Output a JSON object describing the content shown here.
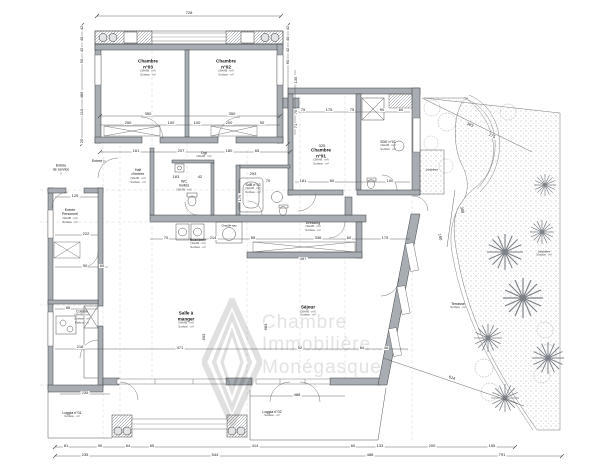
{
  "watermark": {
    "lines": [
      "Chambre",
      "Immobilière",
      "Monégasque"
    ],
    "color": "#e3e3e3"
  },
  "colors": {
    "wall": "#a7adb2",
    "wall_edge": "#3d4144",
    "line": "#555555",
    "dashed": "#8b9196",
    "stipple": "#8a8f94",
    "watermark": "#e3e3e3"
  },
  "plan": {
    "rooms": [
      {
        "name": "Chambre",
        "line2": "n°03",
        "subs": [
          "(SHAB · m²)",
          "Surface · m²"
        ],
        "x": 148,
        "y": 68,
        "cls": ""
      },
      {
        "name": "Chambre",
        "line2": "n°02",
        "subs": [
          "(SHAB · m²)",
          "Surface · m²"
        ],
        "x": 226,
        "y": 68,
        "cls": ""
      },
      {
        "name": "Chambre",
        "line2": "n°01",
        "subs": [
          "(SHAB · m²)",
          "Surface · m²"
        ],
        "x": 321,
        "y": 157,
        "cls": ""
      },
      {
        "name": "SDE n°01",
        "subs": [
          "(SHAB · m²)",
          "Surface · m²"
        ],
        "x": 388,
        "y": 146,
        "cls": "minor"
      },
      {
        "name": "SdB n°02",
        "subs": [
          "(SHAB · m²)",
          "Surface · m²"
        ],
        "x": 253,
        "y": 189,
        "cls": "minor"
      },
      {
        "name": "WC",
        "line2": "Invités",
        "subs": [
          "(SHAB · m²)"
        ],
        "x": 184,
        "y": 186,
        "cls": "minor"
      },
      {
        "name": "Dgt",
        "subs": [
          "(SHAB · m²)"
        ],
        "x": 204,
        "y": 155,
        "cls": "minor"
      },
      {
        "name": "Hall",
        "line2": "d'entrée",
        "subs": [
          "(SHAB · m²)",
          "Surface · m²"
        ],
        "x": 138,
        "y": 176,
        "cls": "minor"
      },
      {
        "name": "Entrée",
        "line2": "de service",
        "subs": [
          "▽"
        ],
        "x": 61,
        "y": 170,
        "cls": "minor"
      },
      {
        "name": "Entrée ▷",
        "subs": [],
        "x": 99,
        "y": 161,
        "cls": "minor"
      },
      {
        "name": "Entrée",
        "line2": "Personnel",
        "subs": [
          "(SHAB · m²)",
          "Surface · m²"
        ],
        "x": 70,
        "y": 216,
        "cls": "minor"
      },
      {
        "name": "Cuisine",
        "subs": [
          "(SHAB · m²)",
          "Surface · m²",
          "Plafond · m"
        ],
        "x": 82,
        "y": 317,
        "cls": "minor"
      },
      {
        "name": "Buanderie",
        "subs": [
          "(SHAB · m²)",
          "Surface · m²"
        ],
        "x": 198,
        "y": 244,
        "cls": "minor"
      },
      {
        "name": "Dressing",
        "subs": [
          "(SHAB · m²)",
          "Surface · m²"
        ],
        "x": 313,
        "y": 227,
        "cls": "minor"
      },
      {
        "name": "Chauffe-eau",
        "subs": [],
        "x": 229,
        "y": 226,
        "cls": "small"
      },
      {
        "name": "Salle à",
        "line2": "manger",
        "subs": [
          "(SHAB · m²)",
          "Surface · m²"
        ],
        "x": 186,
        "y": 320,
        "cls": ""
      },
      {
        "name": "Séjour",
        "subs": [
          "(SHAB · m²)",
          "Surface · m²"
        ],
        "x": 308,
        "y": 311,
        "cls": ""
      },
      {
        "name": "Loggia n°01",
        "subs": [
          "Surface · m²"
        ],
        "x": 72,
        "y": 415,
        "cls": "minor"
      },
      {
        "name": "Loggia n°02",
        "subs": [
          "Surface · m²"
        ],
        "x": 272,
        "y": 414,
        "cls": "minor"
      },
      {
        "name": "Terrasse",
        "subs": [
          "Surface · m²"
        ],
        "x": 458,
        "y": 306,
        "cls": "minor"
      },
      {
        "name": "Jardinière",
        "subs": [],
        "x": 432,
        "y": 170,
        "cls": "small"
      },
      {
        "name": "Jardinière",
        "subs": [
          "Surface · m²"
        ],
        "x": 544,
        "y": 254,
        "cls": "small"
      }
    ],
    "dimensions": [
      {
        "v": "728",
        "x": 189,
        "y": 13
      },
      {
        "v": "350",
        "x": 148,
        "y": 114
      },
      {
        "v": "350",
        "x": 232,
        "y": 114
      },
      {
        "v": "250",
        "x": 128,
        "y": 123
      },
      {
        "v": "100",
        "x": 171,
        "y": 123
      },
      {
        "v": "100",
        "x": 197,
        "y": 123
      },
      {
        "v": "200",
        "x": 229,
        "y": 123
      },
      {
        "v": "50",
        "x": 262,
        "y": 123
      },
      {
        "v": "42",
        "x": 82,
        "y": 28,
        "r": -90
      },
      {
        "v": "40",
        "x": 82,
        "y": 39,
        "r": -90
      },
      {
        "v": "42",
        "x": 82,
        "y": 50,
        "r": -90
      },
      {
        "v": "50",
        "x": 82,
        "y": 61,
        "r": -90
      },
      {
        "v": "486",
        "x": 82,
        "y": 95,
        "r": -90
      },
      {
        "v": "110",
        "x": 82,
        "y": 112,
        "r": -90
      },
      {
        "v": "25",
        "x": 82,
        "y": 141,
        "r": -90
      },
      {
        "v": "42",
        "x": 288,
        "y": 28,
        "r": -90
      },
      {
        "v": "40",
        "x": 288,
        "y": 39,
        "r": -90
      },
      {
        "v": "42",
        "x": 288,
        "y": 50,
        "r": -90
      },
      {
        "v": "60",
        "x": 288,
        "y": 62,
        "r": -90
      },
      {
        "v": "135",
        "x": 296,
        "y": 80,
        "r": -90
      },
      {
        "v": "75",
        "x": 296,
        "y": 112,
        "r": -90
      },
      {
        "v": "71",
        "x": 296,
        "y": 126,
        "r": -90
      },
      {
        "v": "161",
        "x": 136,
        "y": 151
      },
      {
        "v": "207",
        "x": 181,
        "y": 151
      },
      {
        "v": "180",
        "x": 229,
        "y": 151
      },
      {
        "v": "65",
        "x": 257,
        "y": 151
      },
      {
        "v": "75",
        "x": 303,
        "y": 110
      },
      {
        "v": "175",
        "x": 329,
        "y": 110
      },
      {
        "v": "75",
        "x": 352,
        "y": 110
      },
      {
        "v": "90",
        "x": 382,
        "y": 110
      },
      {
        "v": "60",
        "x": 401,
        "y": 110
      },
      {
        "v": "325",
        "x": 322,
        "y": 146
      },
      {
        "v": "163",
        "x": 176,
        "y": 177
      },
      {
        "v": "42",
        "x": 200,
        "y": 177
      },
      {
        "v": "293",
        "x": 253,
        "y": 174
      },
      {
        "v": "70",
        "x": 268,
        "y": 181
      },
      {
        "v": "181",
        "x": 303,
        "y": 181
      },
      {
        "v": "60",
        "x": 332,
        "y": 181
      },
      {
        "v": "100",
        "x": 390,
        "y": 181
      },
      {
        "v": "176",
        "x": 240,
        "y": 198,
        "r": -90
      },
      {
        "v": "65",
        "x": 253,
        "y": 238
      },
      {
        "v": "336",
        "x": 318,
        "y": 238
      },
      {
        "v": "60",
        "x": 349,
        "y": 238
      },
      {
        "v": "175",
        "x": 385,
        "y": 238
      },
      {
        "v": "214",
        "x": 213,
        "y": 238
      },
      {
        "v": "70",
        "x": 166,
        "y": 238
      },
      {
        "v": "497",
        "x": 303,
        "y": 259
      },
      {
        "v": "125",
        "x": 75,
        "y": 196
      },
      {
        "v": "222",
        "x": 86,
        "y": 234
      },
      {
        "v": "90",
        "x": 85,
        "y": 266
      },
      {
        "v": "60",
        "x": 102,
        "y": 266
      },
      {
        "v": "65",
        "x": 68,
        "y": 308
      },
      {
        "v": "218",
        "x": 80,
        "y": 347
      },
      {
        "v": "235",
        "x": 85,
        "y": 393
      },
      {
        "v": "471",
        "x": 180,
        "y": 348
      },
      {
        "v": "603",
        "x": 204,
        "y": 337,
        "r": -90
      },
      {
        "v": "683",
        "x": 266,
        "y": 327,
        "r": -90
      },
      {
        "v": "52",
        "x": 300,
        "y": 348
      },
      {
        "v": "64",
        "x": 362,
        "y": 348
      },
      {
        "v": "46",
        "x": 386,
        "y": 348
      },
      {
        "v": "488",
        "x": 297,
        "y": 395
      },
      {
        "v": "81",
        "x": 66,
        "y": 446
      },
      {
        "v": "90",
        "x": 100,
        "y": 446
      },
      {
        "v": "64",
        "x": 128,
        "y": 446
      },
      {
        "v": "65",
        "x": 152,
        "y": 446
      },
      {
        "v": "414",
        "x": 255,
        "y": 446
      },
      {
        "v": "60",
        "x": 353,
        "y": 446
      },
      {
        "v": "133",
        "x": 380,
        "y": 446
      },
      {
        "v": "200",
        "x": 432,
        "y": 446
      },
      {
        "v": "155",
        "x": 492,
        "y": 446
      },
      {
        "v": "235",
        "x": 85,
        "y": 455
      },
      {
        "v": "544",
        "x": 215,
        "y": 455
      },
      {
        "v": "488",
        "x": 370,
        "y": 455
      },
      {
        "v": "791",
        "x": 502,
        "y": 455
      },
      {
        "v": "383",
        "x": 470,
        "y": 125,
        "r": 25
      },
      {
        "v": "275",
        "x": 492,
        "y": 136,
        "r": 25
      },
      {
        "v": "308",
        "x": 462,
        "y": 210,
        "r": 80
      },
      {
        "v": "150",
        "x": 440,
        "y": 237,
        "r": 80
      },
      {
        "v": "614",
        "x": 452,
        "y": 378,
        "r": 19
      }
    ]
  }
}
